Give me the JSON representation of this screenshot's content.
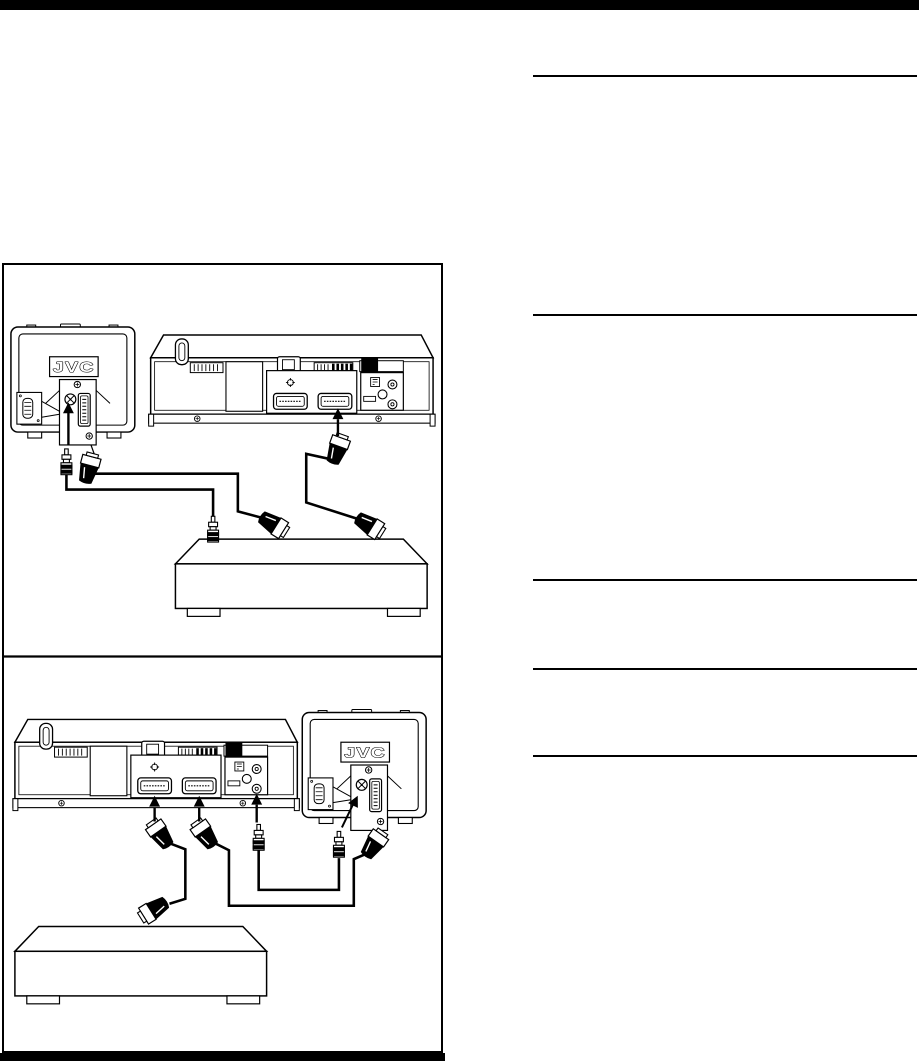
{
  "page": {
    "background": "#ffffff",
    "ink": "#000000"
  },
  "brand": {
    "tv_logo": "JVC"
  },
  "panels": [
    {
      "id": "connection-diagram-1",
      "devices": [
        "tv-rear-view",
        "vcr-rear-view",
        "satellite-receiver"
      ],
      "connectors": [
        "scart-cable-tv",
        "scart-cable-vcr",
        "aerial-cable"
      ]
    },
    {
      "id": "connection-diagram-2",
      "devices": [
        "vcr-rear-view",
        "tv-rear-view",
        "satellite-receiver"
      ],
      "connectors": [
        "scart-cable-av1",
        "scart-cable-av2",
        "aerial-cable"
      ]
    }
  ]
}
